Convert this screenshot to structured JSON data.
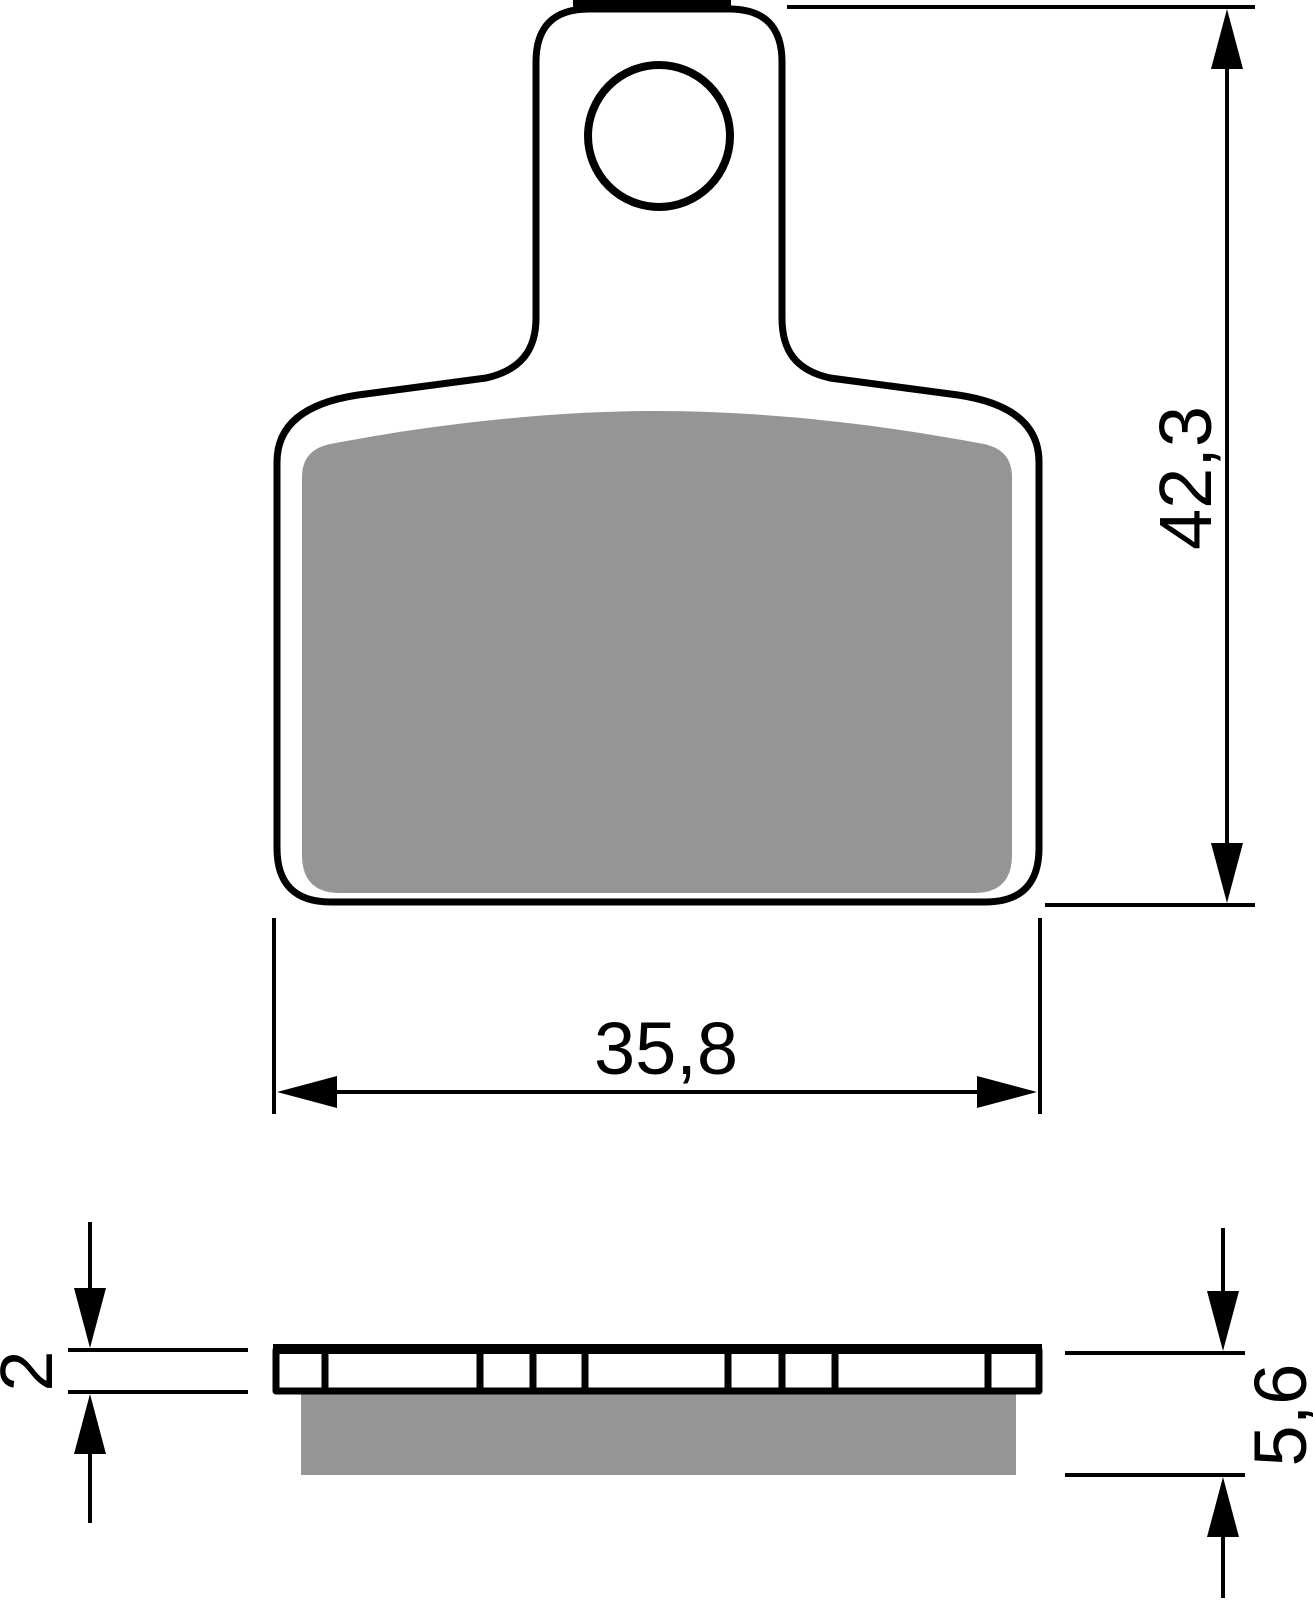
{
  "drawing": {
    "background_color": "#ffffff",
    "line_color": "#000000",
    "friction_material_color": "#959595",
    "dimensions": {
      "overall_height": {
        "label": "42,3",
        "orientation": "vertical",
        "view": "front"
      },
      "overall_width": {
        "label": "35,8",
        "orientation": "horizontal",
        "view": "front"
      },
      "backplate_thickness": {
        "label": "2",
        "orientation": "vertical",
        "view": "side"
      },
      "total_thickness": {
        "label": "5,6",
        "orientation": "vertical",
        "view": "side"
      }
    }
  }
}
